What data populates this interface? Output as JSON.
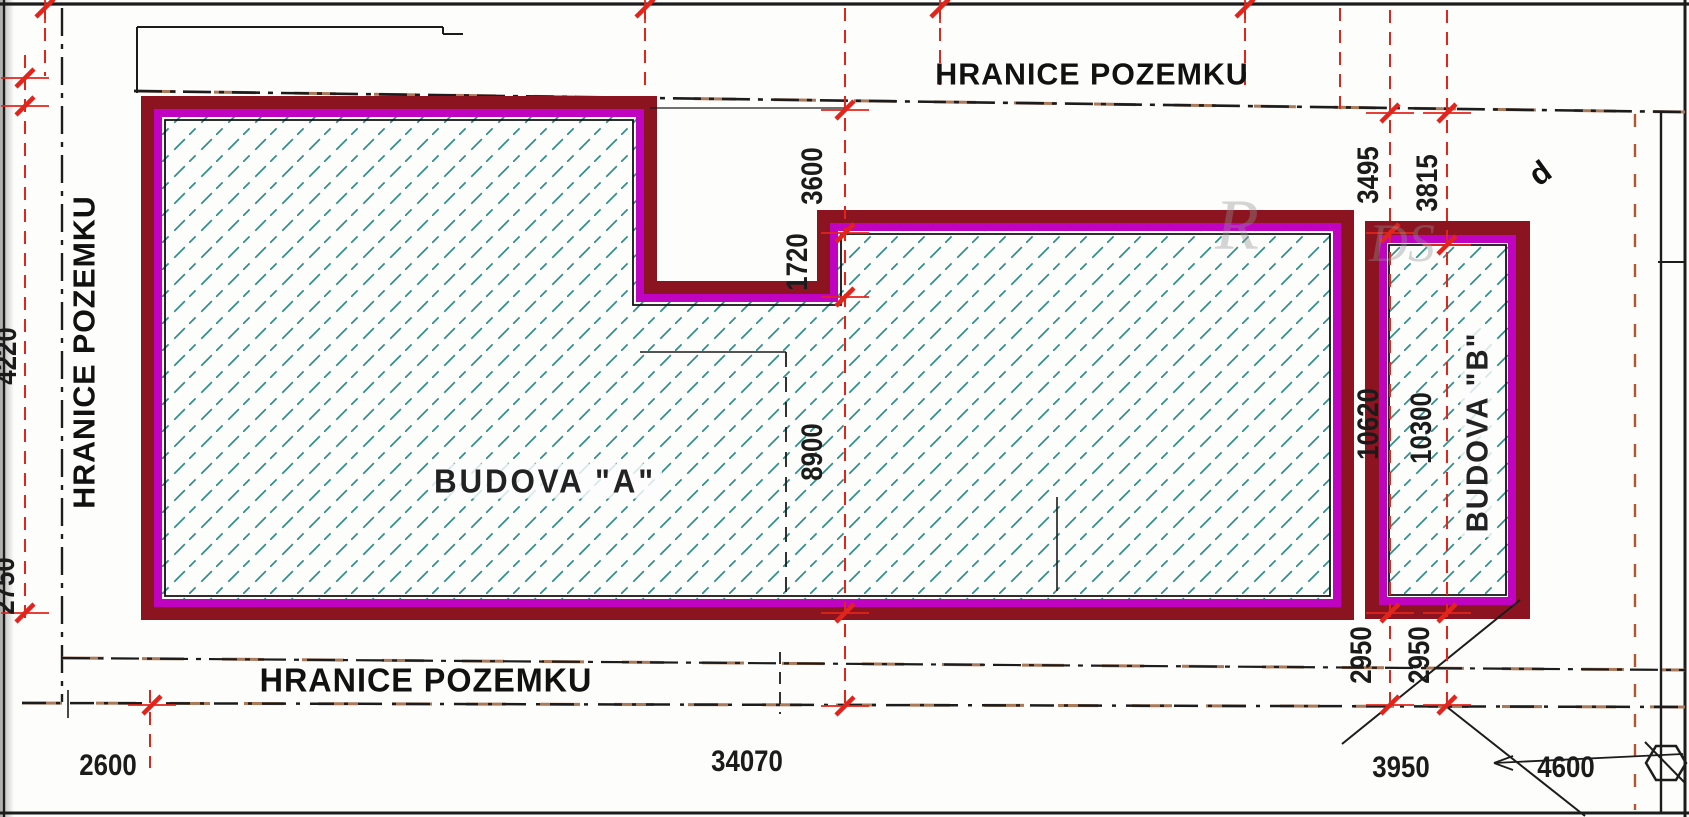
{
  "meta": {
    "type": "architectural site plan (scanned)"
  },
  "colors": {
    "wall_outer": "#8c1420",
    "wall_inner": "#c003c0",
    "hatch": "#2f8f88",
    "dimension": "#e2251c",
    "line": "#1c1c1c",
    "boundary_alt": "#a9795a"
  },
  "boundary": {
    "top_label": "HRANICE POZEMKU",
    "left_label": "HRANICE POZEMKU",
    "bottom_label": "HRANICE POZEMKU"
  },
  "buildings": {
    "a": {
      "label": "BUDOVA \"A\""
    },
    "b": {
      "label": "BUDOVA \"B\""
    }
  },
  "dims": {
    "d3600": "3600",
    "d1720": "1720",
    "d8900": "8900",
    "d3495": "3495",
    "d3815": "3815",
    "d10620": "10620",
    "d10300": "10300",
    "d2950a": "2950",
    "d2950b": "2950",
    "d2600": "2600",
    "d34070": "34070",
    "d3950": "3950",
    "d4600": "4600",
    "dleft_top_clipped": "4220",
    "dleft_bottom_clipped": "2750"
  },
  "annotations": {
    "stray_letter": "d",
    "watermark_part1": "R",
    "watermark_part2": "DS"
  }
}
